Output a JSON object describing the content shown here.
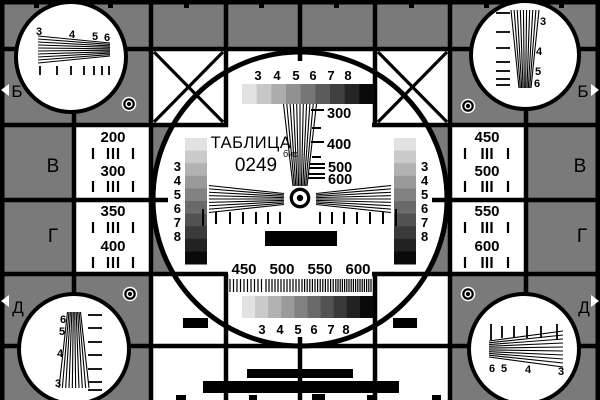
{
  "card": {
    "title": "ТАБЛИЦА",
    "number": "0249",
    "number_suffix": "бис"
  },
  "edge_letters": {
    "left": [
      "Б",
      "В",
      "Г",
      "Д"
    ],
    "right": [
      "Б",
      "В",
      "Г",
      "Д"
    ]
  },
  "gray_scale_labels": [
    "3",
    "4",
    "5",
    "6",
    "7",
    "8"
  ],
  "center_frequency_scale": [
    "300",
    "400",
    "500",
    "600"
  ],
  "bottom_frequency_scale": [
    "450",
    "500",
    "550",
    "600"
  ],
  "left_panel_frequencies": [
    "200",
    "300",
    "350",
    "400"
  ],
  "right_panel_frequencies": [
    "450",
    "500",
    "550",
    "600"
  ],
  "corner_wedge_numbers": {
    "top_left": [
      "3",
      "4",
      "5",
      "6"
    ],
    "top_right": [
      "3",
      "4",
      "5",
      "6"
    ],
    "bottom_left": [
      "6",
      "5",
      "4",
      "3"
    ],
    "bottom_right": [
      "6",
      "5",
      "4",
      "3"
    ]
  },
  "colors": {
    "background": "#7a7a7a",
    "ink": "#000000",
    "paper": "#ffffff"
  }
}
